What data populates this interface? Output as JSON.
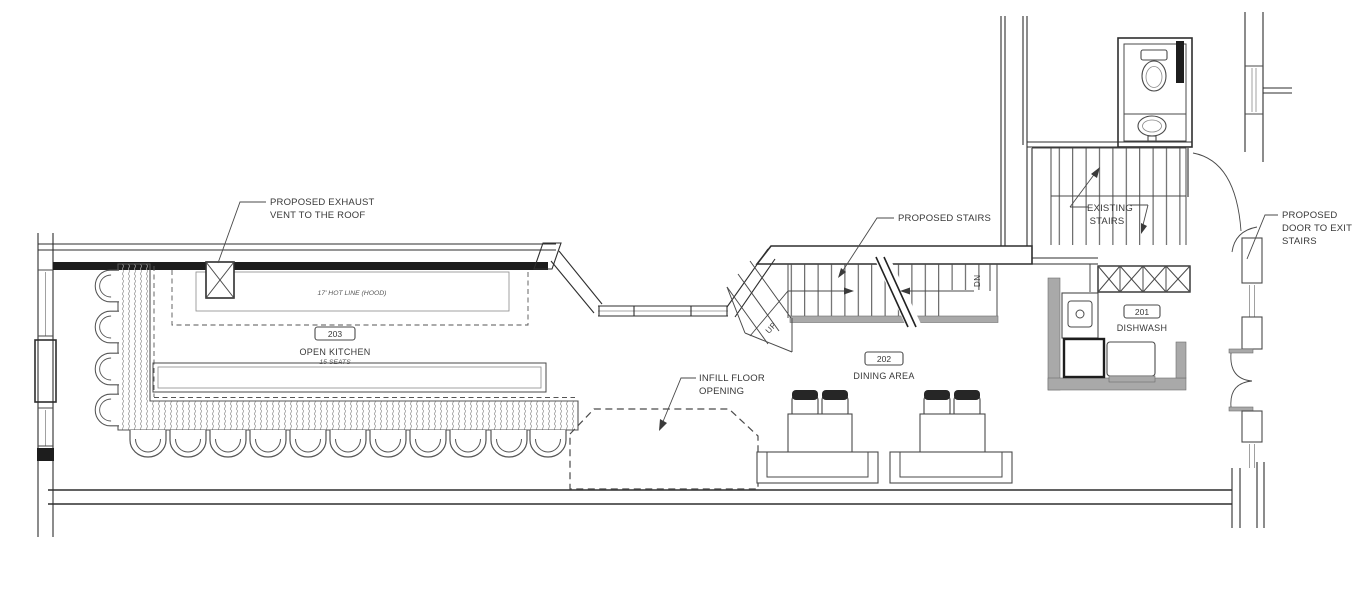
{
  "annotations": {
    "exhaust_vent": {
      "l1": "PROPOSED EXHAUST",
      "l2": "VENT TO THE ROOF"
    },
    "proposed_stairs": {
      "l1": "PROPOSED STAIRS"
    },
    "existing_stairs": {
      "l1": "EXISTING",
      "l2": "STAIRS"
    },
    "proposed_door": {
      "l1": "PROPOSED",
      "l2": "DOOR TO EXIT",
      "l3": "STAIRS"
    },
    "infill_opening": {
      "l1": "INFILL FLOOR",
      "l2": "OPENING"
    }
  },
  "rooms": {
    "open_kitchen": {
      "number": "203",
      "name": "OPEN KITCHEN",
      "seats": "15 SEATS"
    },
    "dining_area": {
      "number": "202",
      "name": "DINING AREA"
    },
    "dishwash": {
      "number": "201",
      "name": "DISHWASH"
    }
  },
  "equipment_labels": {
    "hot_line": "17' HOT LINE (HOOD)"
  },
  "stair_labels": {
    "up": "UP",
    "dn": "DN"
  },
  "colors": {
    "line": "#2e2e2e",
    "detail": "#4a4a4a",
    "shadow_gray": "#a9a9a9",
    "hatch": "#9a9a9a",
    "background": "#ffffff"
  }
}
